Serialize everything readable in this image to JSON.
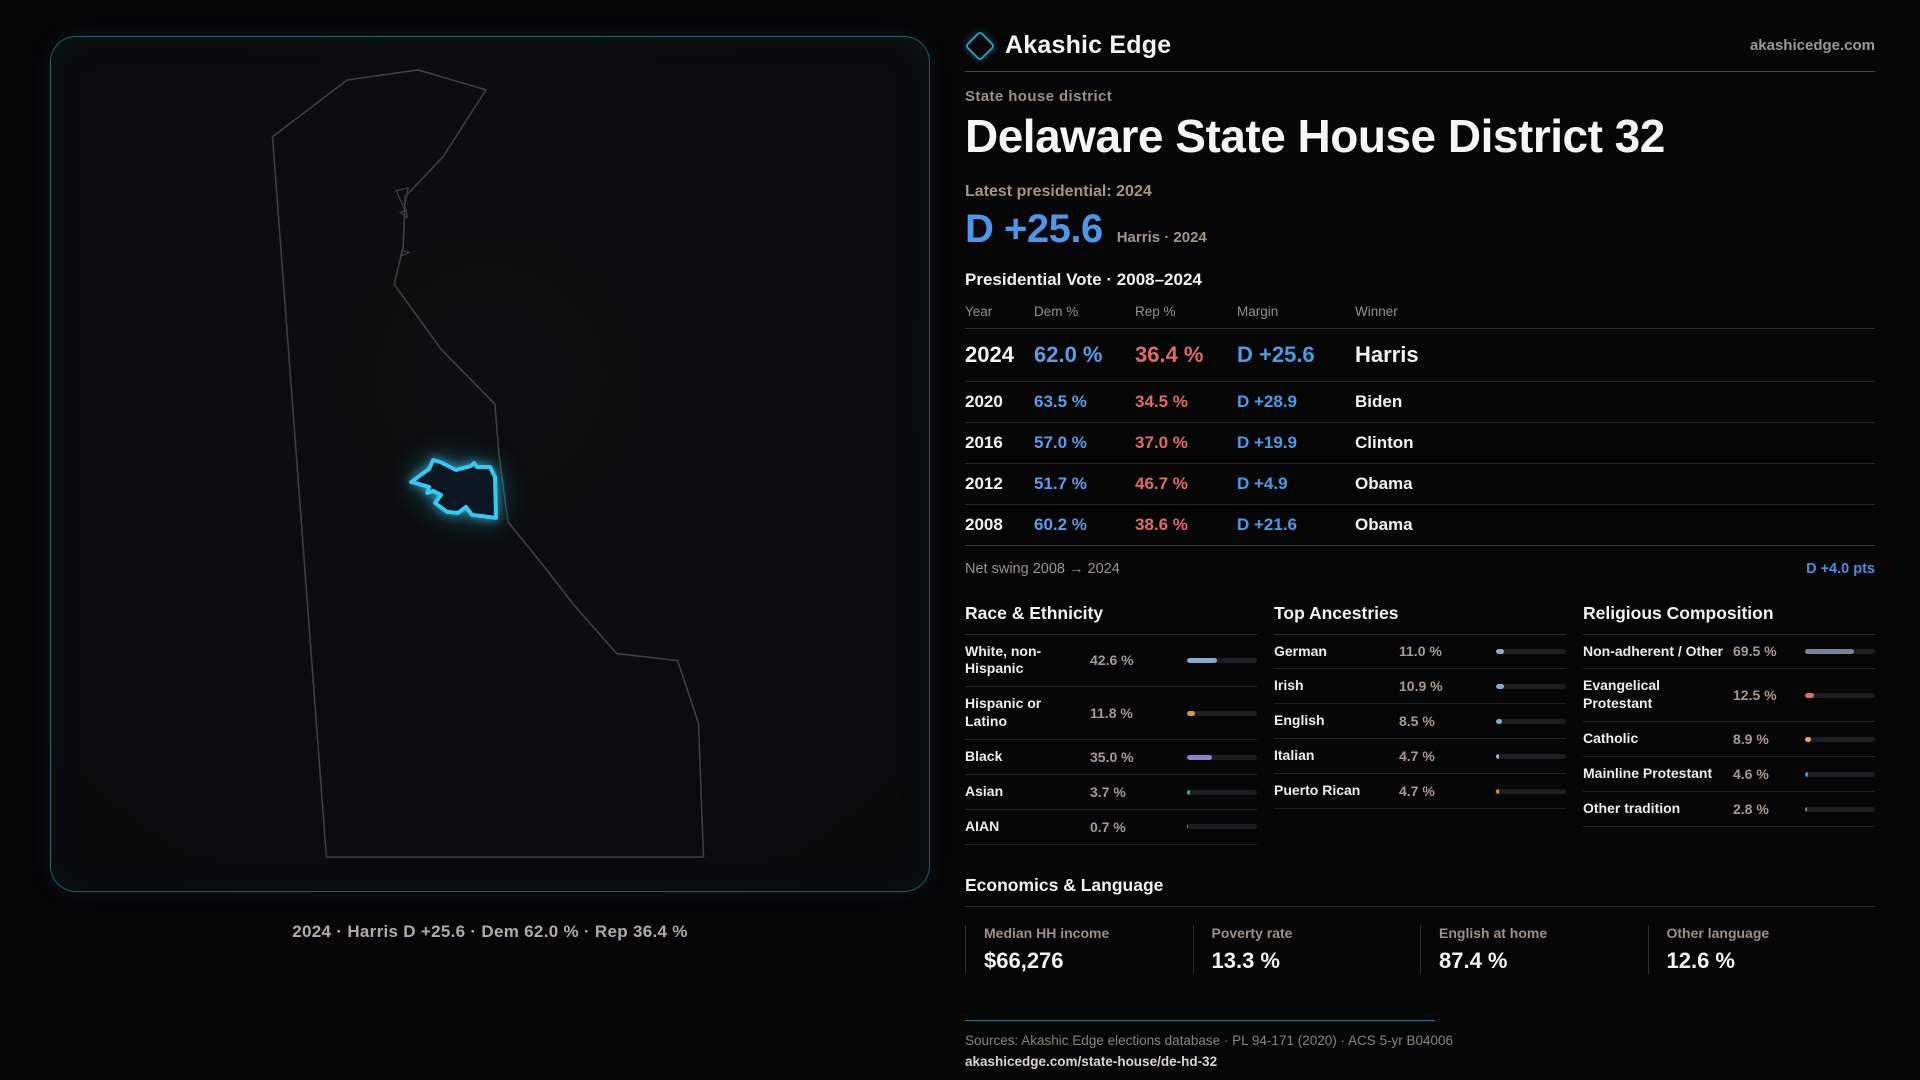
{
  "brand": {
    "name": "Akashic Edge",
    "domain": "akashicedge.com"
  },
  "page": {
    "eyebrow": "State house district",
    "title": "Delaware State House District 32",
    "latest_label": "Latest presidential: 2024",
    "headline_margin": "D +25.6",
    "headline_context": "Harris · 2024"
  },
  "map": {
    "caption": "2024 · Harris D +25.6 · Dem 62.0 % · Rep 36.4 %"
  },
  "vote_table": {
    "title": "Presidential Vote · 2008–2024",
    "columns": [
      "Year",
      "Dem %",
      "Rep %",
      "Margin",
      "Winner"
    ],
    "rows": [
      {
        "year": "2024",
        "dem": "62.0 %",
        "rep": "36.4 %",
        "margin": "D +25.6",
        "winner": "Harris",
        "featured": true
      },
      {
        "year": "2020",
        "dem": "63.5 %",
        "rep": "34.5 %",
        "margin": "D +28.9",
        "winner": "Biden",
        "featured": false
      },
      {
        "year": "2016",
        "dem": "57.0 %",
        "rep": "37.0 %",
        "margin": "D +19.9",
        "winner": "Clinton",
        "featured": false
      },
      {
        "year": "2012",
        "dem": "51.7 %",
        "rep": "46.7 %",
        "margin": "D +4.9",
        "winner": "Obama",
        "featured": false
      },
      {
        "year": "2008",
        "dem": "60.2 %",
        "rep": "38.6 %",
        "margin": "D +21.6",
        "winner": "Obama",
        "featured": false
      }
    ],
    "net_swing_label": "Net swing 2008 → 2024",
    "net_swing_value": "D +4.0 pts"
  },
  "demographics": [
    {
      "title": "Race & Ethnicity",
      "rows": [
        {
          "label": "White, non-Hispanic",
          "value": "42.6 %",
          "pct": 42.6,
          "color": "#8fa9c9"
        },
        {
          "label": "Hispanic or Latino",
          "value": "11.8 %",
          "pct": 11.8,
          "color": "#d9993c"
        },
        {
          "label": "Black",
          "value": "35.0 %",
          "pct": 35.0,
          "color": "#8d7fd9"
        },
        {
          "label": "Asian",
          "value": "3.7 %",
          "pct": 3.7,
          "color": "#2eb388"
        },
        {
          "label": "AIAN",
          "value": "0.7 %",
          "pct": 0.7,
          "color": "#8a8f96"
        }
      ]
    },
    {
      "title": "Top Ancestries",
      "rows": [
        {
          "label": "German",
          "value": "11.0 %",
          "pct": 11.0,
          "color": "#8fa9c9"
        },
        {
          "label": "Irish",
          "value": "10.9 %",
          "pct": 10.9,
          "color": "#8fa9c9"
        },
        {
          "label": "English",
          "value": "8.5 %",
          "pct": 8.5,
          "color": "#8fa9c9"
        },
        {
          "label": "Italian",
          "value": "4.7 %",
          "pct": 4.7,
          "color": "#9fb4cd"
        },
        {
          "label": "Puerto Rican",
          "value": "4.7 %",
          "pct": 4.7,
          "color": "#d9993c"
        }
      ]
    },
    {
      "title": "Religious Composition",
      "rows": [
        {
          "label": "Non-adherent / Other",
          "value": "69.5 %",
          "pct": 69.5,
          "color": "#74849e"
        },
        {
          "label": "Evangelical Protestant",
          "value": "12.5 %",
          "pct": 12.5,
          "color": "#e06c6c"
        },
        {
          "label": "Catholic",
          "value": "8.9 %",
          "pct": 8.9,
          "color": "#dcb23e"
        },
        {
          "label": "Mainline Protestant",
          "value": "4.6 %",
          "pct": 4.6,
          "color": "#4a90e0"
        },
        {
          "label": "Other tradition",
          "value": "2.8 %",
          "pct": 2.8,
          "color": "#7d828a"
        }
      ]
    }
  ],
  "economics": {
    "title": "Economics & Language",
    "stats": [
      {
        "label": "Median HH income",
        "value": "$66,276"
      },
      {
        "label": "Poverty rate",
        "value": "13.3 %"
      },
      {
        "label": "English at home",
        "value": "87.4 %"
      },
      {
        "label": "Other language",
        "value": "12.6 %"
      }
    ]
  },
  "footer": {
    "sources": "Sources: Akashic Edge elections database · PL 94-171 (2020) · ACS 5-yr B04006",
    "permalink": "akashicedge.com/state-house/de-hd-32"
  },
  "chart_data": [
    {
      "type": "table",
      "title": "Presidential Vote · 2008–2024",
      "columns": [
        "Year",
        "Dem %",
        "Rep %",
        "Margin",
        "Winner"
      ],
      "rows": [
        [
          "2024",
          62.0,
          36.4,
          "D +25.6",
          "Harris"
        ],
        [
          "2020",
          63.5,
          34.5,
          "D +28.9",
          "Biden"
        ],
        [
          "2016",
          57.0,
          37.0,
          "D +19.9",
          "Clinton"
        ],
        [
          "2012",
          51.7,
          46.7,
          "D +4.9",
          "Obama"
        ],
        [
          "2008",
          60.2,
          38.6,
          "D +21.6",
          "Obama"
        ]
      ],
      "annotations": [
        "Net swing 2008 → 2024: D +4.0 pts"
      ]
    },
    {
      "type": "bar",
      "title": "Race & Ethnicity",
      "categories": [
        "White, non-Hispanic",
        "Hispanic or Latino",
        "Black",
        "Asian",
        "AIAN"
      ],
      "values": [
        42.6,
        11.8,
        35.0,
        3.7,
        0.7
      ],
      "xlabel": "",
      "ylabel": "%",
      "xlim": [
        0,
        100
      ]
    },
    {
      "type": "bar",
      "title": "Top Ancestries",
      "categories": [
        "German",
        "Irish",
        "English",
        "Italian",
        "Puerto Rican"
      ],
      "values": [
        11.0,
        10.9,
        8.5,
        4.7,
        4.7
      ],
      "xlabel": "",
      "ylabel": "%",
      "xlim": [
        0,
        100
      ]
    },
    {
      "type": "bar",
      "title": "Religious Composition",
      "categories": [
        "Non-adherent / Other",
        "Evangelical Protestant",
        "Catholic",
        "Mainline Protestant",
        "Other tradition"
      ],
      "values": [
        69.5,
        12.5,
        8.9,
        4.6,
        2.8
      ],
      "xlabel": "",
      "ylabel": "%",
      "xlim": [
        0,
        100
      ]
    }
  ]
}
